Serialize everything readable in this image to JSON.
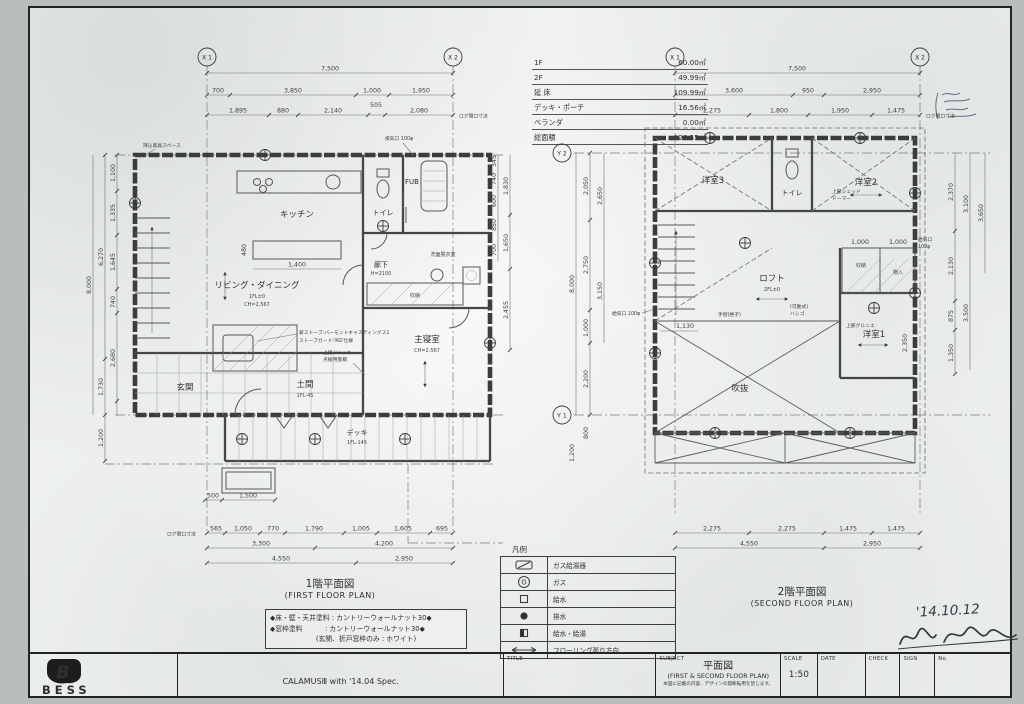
{
  "area_table": {
    "rows": [
      {
        "label": "1F",
        "value": "60.00㎡"
      },
      {
        "label": "2F",
        "value": "49.99㎡"
      },
      {
        "label": "延 床",
        "value": "109.99㎡"
      },
      {
        "label": "デッキ・ポーチ",
        "value": "16.56㎡"
      },
      {
        "label": "ベランダ",
        "value": "0.00㎡"
      },
      {
        "label": "総面積",
        "value": "126.55㎡"
      }
    ]
  },
  "plan1": {
    "title_jp": "1階平面図",
    "title_en": "(FIRST FLOOR PLAN)",
    "grid": {
      "x1": "X 1",
      "x2": "X 2"
    },
    "dims": {
      "top1": "7,500",
      "top2": [
        "700",
        "3,850",
        "1,000",
        "1,950"
      ],
      "top3": [
        "1,895",
        "880",
        "2,140",
        "505",
        "2,080"
      ],
      "left_outer": "8,000",
      "left_mid": [
        "6,270",
        "1,730"
      ],
      "left_inner": [
        "1,100",
        "1,335",
        "1,645",
        "740",
        "2,680"
      ],
      "left_low": [
        "1,200"
      ],
      "right_inner": [
        "345",
        "740",
        "600",
        "850",
        "700"
      ],
      "right_outer": [
        "1,830",
        "1,650",
        "2,455"
      ],
      "bottom1": [
        "565",
        "1,050",
        "770",
        "1,790",
        "1,005",
        "1,605",
        "695"
      ],
      "bottom2": [
        "3,300",
        "4,200"
      ],
      "bottom3": [
        "4,550",
        "2,950"
      ],
      "step": [
        "500",
        "1,500"
      ],
      "kitchen": [
        "1,400",
        "480"
      ],
      "log_note": "ログ間口寸法"
    },
    "rooms": {
      "kitchen": "キッチン",
      "living": "リビング・ダイニング",
      "living_sub1": "1FL±0",
      "living_sub2": "CH=2,567",
      "bedroom": "主寝室",
      "bedroom_sub": "CH=2,567",
      "genkan": "玄関",
      "doma": "土間",
      "doma_sub": "1FL-45",
      "deck": "デッキ",
      "deck_sub": "1FL-145",
      "toilet": "トイレ",
      "bath": "FUB",
      "hall": "廊下",
      "hall_sub": "H=2100",
      "washroom": "洗面脱衣室",
      "closet": "収納"
    },
    "notes": {
      "stove1": "薪ストーブ:バーモントキャスティングス1",
      "stove2": "ストーブガード:'KG'仕様",
      "jack1": "上屋ジャッキ",
      "jack2": "点検用蓋箱",
      "vent_ex": "排気口 100φ",
      "furniture": "持込家具スペース"
    }
  },
  "plan2": {
    "title_jp": "2階平面図",
    "title_en": "(SECOND FLOOR PLAN)",
    "grid": {
      "x1": "X 1",
      "x2": "X 2",
      "y1": "Y 1",
      "y2": "Y 2"
    },
    "dims": {
      "top1": "7,500",
      "top2": [
        "3,600",
        "950",
        "2,950"
      ],
      "top3": [
        "2,275",
        "1,800",
        "1,950",
        "1,475"
      ],
      "left_outer": "8,000",
      "left_inner": [
        "2,050",
        "2,750",
        "1,000",
        "2,200"
      ],
      "left_inner2": [
        "2,650",
        "3,150"
      ],
      "left_low": [
        "800",
        "1,200"
      ],
      "right_inner": [
        "2,370",
        "2,130",
        "875",
        "1,350"
      ],
      "right_outer": [
        "3,100",
        "3,500"
      ],
      "right_far": "3,650",
      "bottom1": [
        "2,275",
        "2,275",
        "1,475",
        "1,475"
      ],
      "bottom2": [
        "4,550",
        "2,950"
      ],
      "stair_dim": "1,130",
      "room1_v": "2,350",
      "closet_dims": [
        "1,000",
        "1,000"
      ],
      "log_note": "ログ間口寸法"
    },
    "rooms": {
      "bed3": "洋室3",
      "bed2": "洋室2",
      "bed1": "洋室1",
      "loft": "ロフト",
      "loft_sub": "2FL±0",
      "toilet": "トイレ",
      "void": "吹抜",
      "closet1": "収納",
      "closet2": "物入"
    },
    "notes": {
      "dormer1": "上部シェッド",
      "dormer2": "ドーマー",
      "rail": "手摺(格子)",
      "ladder1": "(可動式)",
      "ladder2": "ハシゴ",
      "grenier": "上部グルニエ",
      "vent": "給気口 100φ",
      "vent1": "給気口",
      "vent2": "100φ"
    }
  },
  "legend": {
    "title": "凡例",
    "rows": [
      {
        "icon": "gas-heater",
        "label": "ガス給湯器"
      },
      {
        "icon": "gas",
        "label": "ガス"
      },
      {
        "icon": "water-supply",
        "label": "給水"
      },
      {
        "icon": "drain",
        "label": "排水"
      },
      {
        "icon": "hot-cold-water",
        "label": "給水・給湯"
      },
      {
        "icon": "flooring-direction",
        "label": "フローリング張り方向"
      }
    ]
  },
  "spec_notes": {
    "line1": "◆床・壁・天井塗料 : カントリーウォールナット30◆",
    "line2": "◆窓枠塗料　　　 : カントリーウォールナット30◆",
    "line3": "(玄関、折戸窓枠のみ : ホワイト)"
  },
  "titleblock": {
    "title_label": "TITLE",
    "subject_label": "SUBJECT",
    "subject": "平面図",
    "subject_en": "(FIRST & SECOND FLOOR PLAN)",
    "subject_note": "本図に記載の内容、デザインの無断転用を禁じます。",
    "scale_label": "SCALE",
    "scale_value": "1:50",
    "date_label": "DATE",
    "check_label": "CHECK",
    "sign_label": "SIGN",
    "no_label": "No.",
    "brand": "BESS",
    "brand_mark": "B",
    "product": "CALAMUSⅢ with '14.04 Spec."
  },
  "handwriting": {
    "date": "'14.10.12"
  }
}
